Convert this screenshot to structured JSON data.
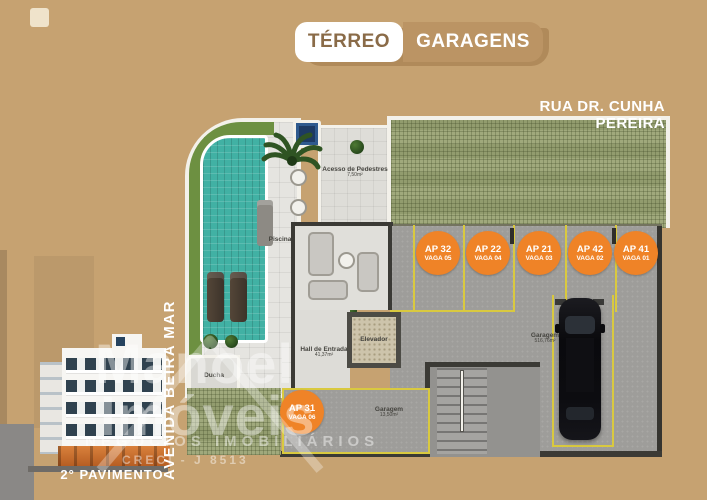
{
  "colors": {
    "background_tan": "#c6a271",
    "tab_tan": "#bb9464",
    "accent_orange": "#ef8327",
    "parking_yellow": "#d9c93f",
    "pool_teal": "#41b1a4",
    "pavers_green": "#9aa474",
    "wall_dark": "#3b3a35"
  },
  "header": {
    "tab_terreo": "TÉRREO",
    "tab_garagens": "GARAGENS"
  },
  "streets": {
    "top": "RUA DR. CUNHA PEREIRA",
    "left": "AVENIDA BEIRA MAR"
  },
  "plan": {
    "labels": {
      "piscina": "Piscina",
      "acesso": "Acesso de Pedestres",
      "acesso_area": "7,50m²",
      "hall": "Hall de Entrada",
      "hall_area": "41,37m²",
      "elevador": "Elevador",
      "ducha": "Ducha",
      "garagem_main": "Garagem",
      "garagem_main_area": "516,76m²",
      "garagem_small": "Garagem",
      "garagem_small_area": "13,50m²"
    },
    "parking_spots": [
      {
        "ap": "AP 32",
        "vaga": "VAGA 05"
      },
      {
        "ap": "AP 22",
        "vaga": "VAGA 04"
      },
      {
        "ap": "AP 21",
        "vaga": "VAGA 03"
      },
      {
        "ap": "AP 42",
        "vaga": "VAGA 02"
      },
      {
        "ap": "AP 41",
        "vaga": "VAGA 01"
      }
    ],
    "parking_spot_31": {
      "ap": "AP 31",
      "vaga": "VAGA 06"
    }
  },
  "watermark": {
    "line1": "Manoel",
    "line2": "Imóveis",
    "line3": "NEGÓCIOS IMOBILIÁRIOS",
    "line4": "CRECI - J 8513"
  },
  "thumbnail": {
    "caption": "2° PAVIMENTO"
  }
}
